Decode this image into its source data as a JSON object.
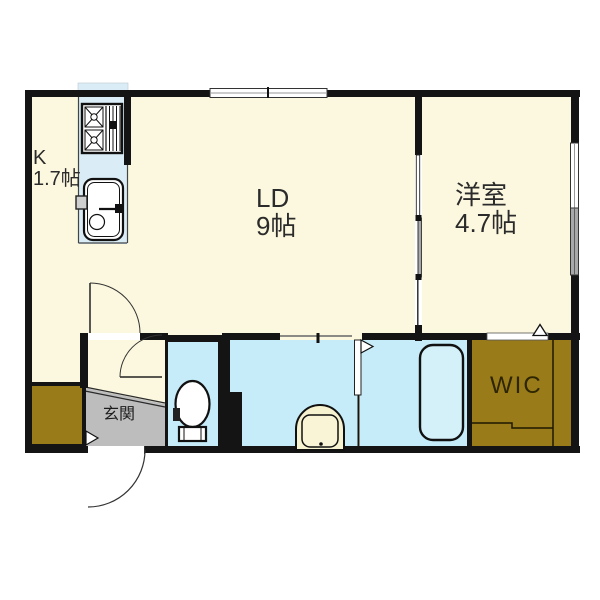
{
  "plan_title": "1LDK apartment floor plan",
  "labels": {
    "kitchen_name": "K",
    "kitchen_size": "1.7帖",
    "living_dining_name": "LD",
    "living_dining_size": "9帖",
    "western_room_name": "洋室",
    "western_room_size": "4.7帖",
    "entrance_name": "玄関",
    "wic_name": "WIC"
  },
  "rooms": [
    {
      "id": "kitchen",
      "label": "K",
      "size": "1.7帖"
    },
    {
      "id": "living-dining",
      "label": "LD",
      "size": "9帖"
    },
    {
      "id": "western-room",
      "label": "洋室",
      "size": "4.7帖"
    },
    {
      "id": "entrance",
      "label": "玄関",
      "size": ""
    },
    {
      "id": "walk-in-closet",
      "label": "WIC",
      "size": ""
    }
  ],
  "icons": {
    "stove": "stove-icon",
    "kitchen_sink": "kitchen-sink-icon",
    "toilet": "toilet-icon",
    "washbasin": "washbasin-icon",
    "bathtub": "bathtub-icon",
    "door_arcs": "door-swing-arc",
    "door_flags": "door-direction-triangle"
  },
  "colors": {
    "floor_cream": "#FCF8DF",
    "wet_area_blue": "#C5ECF8",
    "kitchen_blue": "#DAEDF6",
    "bathtub_blue": "#D4F1FA",
    "closet_olive": "#9A7B1A",
    "entrance_gray": "#BDBDBD",
    "wall_black": "#141414",
    "window_gray_pane": "#A9A9A9"
  }
}
